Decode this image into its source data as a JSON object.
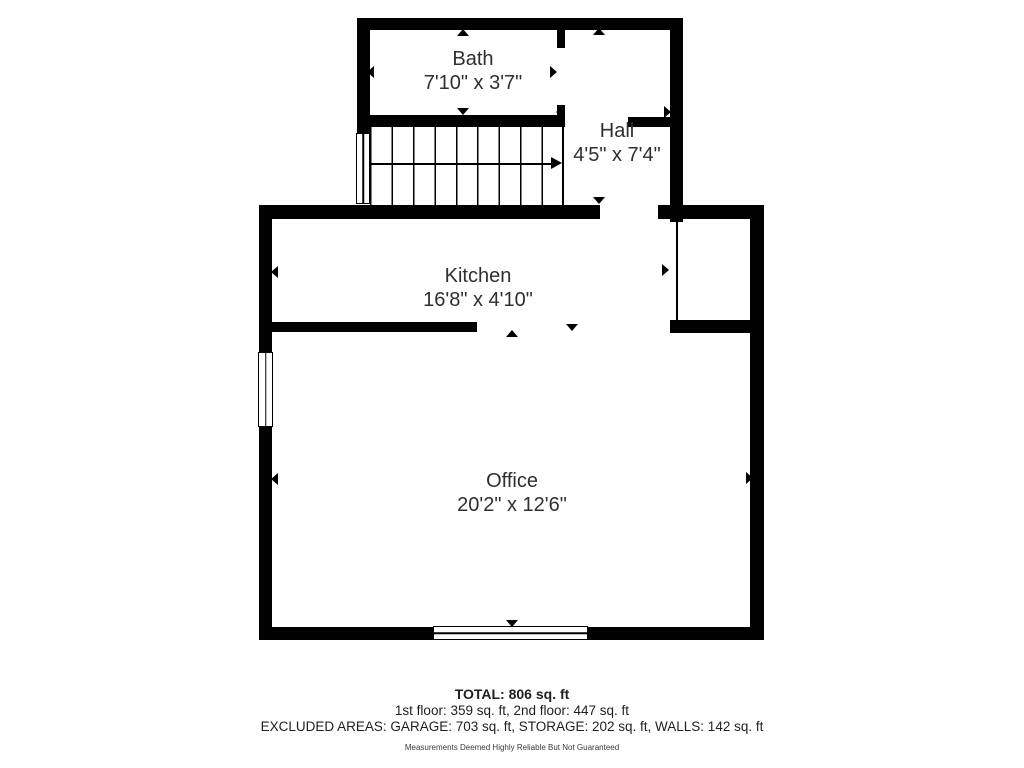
{
  "floorplan": {
    "rooms": {
      "bath": {
        "name": "Bath",
        "dims": "7'10\" x 3'7\""
      },
      "hall": {
        "name": "Hall",
        "dims": "4'5\" x 7'4\""
      },
      "kitchen": {
        "name": "Kitchen",
        "dims": "16'8\" x 4'10\""
      },
      "office": {
        "name": "Office",
        "dims": "20'2\" x 12'6\""
      }
    },
    "summary": {
      "total": "TOTAL: 806 sq. ft",
      "floors": "1st floor: 359 sq. ft, 2nd floor: 447 sq. ft",
      "excluded": "EXCLUDED AREAS: GARAGE: 703 sq. ft, STORAGE: 202 sq. ft, WALLS: 142 sq. ft",
      "disclaimer": "Measurements Deemed Highly Reliable But Not Guaranteed"
    },
    "colors": {
      "wall": "#000000",
      "text": "#2f2f2f",
      "background": "#ffffff"
    }
  }
}
